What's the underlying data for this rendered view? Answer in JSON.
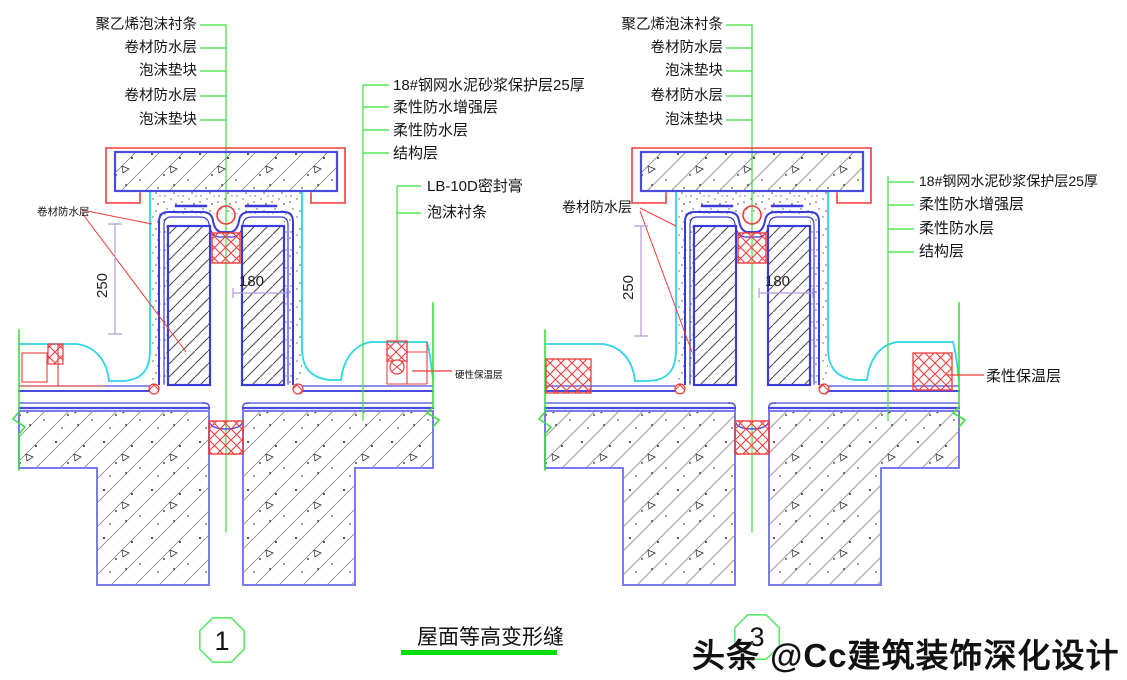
{
  "title": {
    "text": "屋面等高变形缝"
  },
  "watermark": {
    "text": "头条 @Cc建筑装饰深化设计"
  },
  "details": {
    "left": {
      "bubble_number": "1",
      "top_labels": [
        "聚乙烯泡沫衬条",
        "卷材防水层",
        "泡沫垫块",
        "卷材防水层",
        "泡沫垫块"
      ],
      "layer_labels": [
        "18#钢网水泥砂浆保护层25厚",
        "柔性防水增强层",
        "柔性防水层",
        "结构层"
      ],
      "joint_labels": [
        "LB-10D密封膏",
        "泡沫衬条"
      ],
      "membrane_label": "卷材防水层",
      "insulation_label": "硬性保温层",
      "dim_height": "250",
      "dim_width": "180"
    },
    "right": {
      "bubble_number": "3",
      "top_labels": [
        "聚乙烯泡沫衬条",
        "卷材防水层",
        "泡沫垫块",
        "卷材防水层",
        "泡沫垫块"
      ],
      "layer_labels": [
        "18#钢网水泥砂浆保护层25厚",
        "柔性防水增强层",
        "柔性防水层",
        "结构层"
      ],
      "membrane_label": "卷材防水层",
      "insulation_label": "柔性保温层",
      "dim_height": "250",
      "dim_width": "180"
    }
  },
  "colors": {
    "leader_green": "#3be03b",
    "structure_blue": "#3b3bd9",
    "slab_blue": "#7b7bf0",
    "membrane_cyan": "#2fd5e8",
    "sealant_red": "#f23b3b",
    "dim_purple": "#b49ae0",
    "title_underline_green": "#00dd00",
    "bubble_green": "#5ee86a",
    "watermark_gray": "#3a3a3a"
  }
}
